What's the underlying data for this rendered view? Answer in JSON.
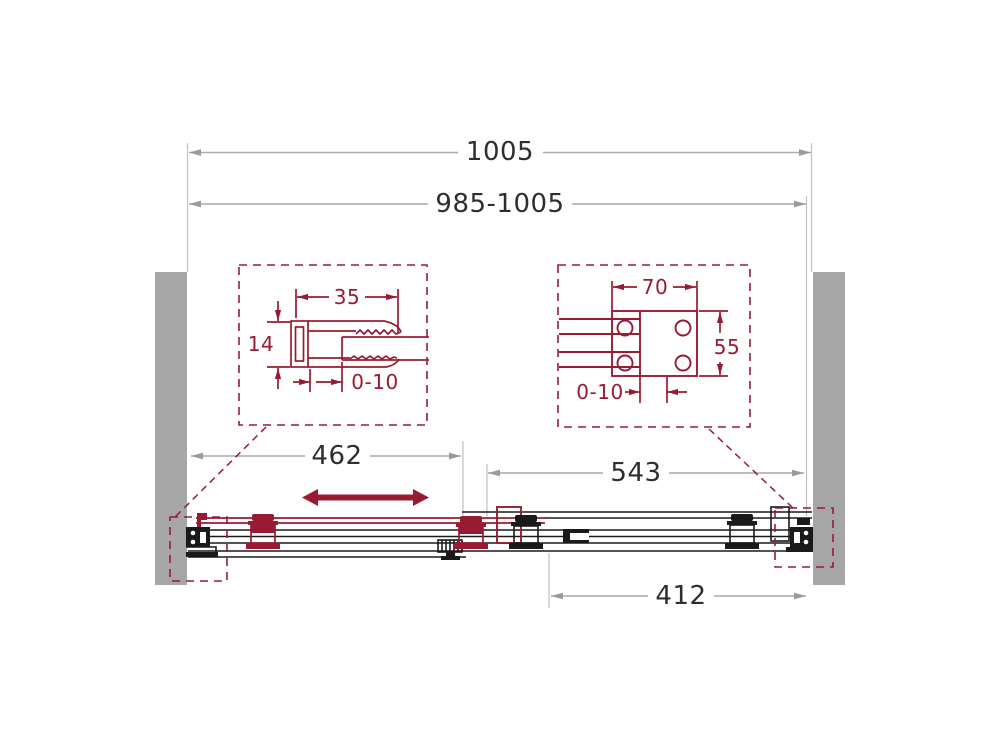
{
  "title": "Sliding door technical drawing",
  "colors": {
    "maroon": "#991b33",
    "line_black": "#1a1a1a",
    "wall_gray": "#a6a6a6",
    "dim_line_gray": "#a9a9a9",
    "dim_text": "#2e2e2e"
  },
  "dimensions": {
    "overall_width": "1005",
    "adjustment_range": "985-1005",
    "sliding_panel_span": "462",
    "right_span": "543",
    "fixed_panel_span": "412"
  },
  "detail_left": {
    "profile_width": "35",
    "profile_depth": "14",
    "adjustment": "0-10"
  },
  "detail_right": {
    "plate_width": "70",
    "plate_height": "55",
    "adjustment": "0-10"
  },
  "icons": {
    "slide_direction_arrow": "left-right double arrow"
  }
}
